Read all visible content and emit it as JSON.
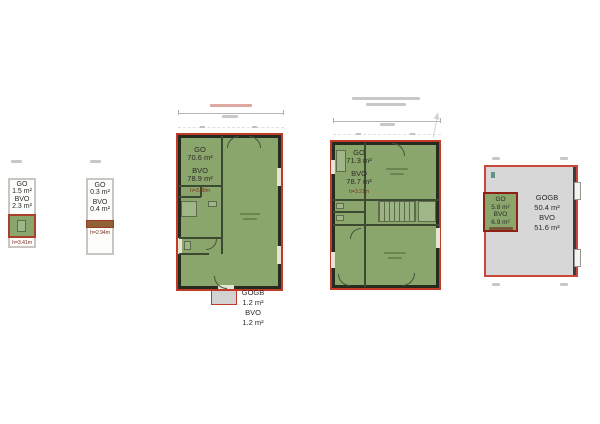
{
  "sheet": {
    "background": "#ffffff"
  },
  "colors": {
    "plan_green": "#8aa66c",
    "plan_gray": "#d7d7d7",
    "outline_red": "#c23b27",
    "inner_box_red": "#8e2114",
    "wall_dark": "#262b1f",
    "brown_bar": "#8f6134",
    "height_note_text": "#7d3222"
  },
  "plans": {
    "left_small": {
      "go_label": "GO",
      "go_value": "1.5 m²",
      "bvo_label": "BVO",
      "bvo_value": "2.3 m²",
      "height_note": "h=3.41m"
    },
    "mid_small": {
      "go_label": "GO",
      "go_value": "0.3 m²",
      "bvo_label": "BVO",
      "bvo_value": "0.4 m²",
      "height_note": "h=2.94m"
    },
    "main_floor": {
      "go_label": "GO",
      "go_value": "70.6 m²",
      "bvo_label": "BVO",
      "bvo_value": "78.9 m²",
      "height_note": "h=3.08m",
      "annex": {
        "gogb_label": "GOGB",
        "gogb_value": "1.2 m²",
        "bvo_label": "BVO",
        "bvo_value": "1.2 m²"
      }
    },
    "upper_floor": {
      "go_label": "GO",
      "go_value": "71.3 m²",
      "bvo_label": "BVO",
      "bvo_value": "78.7 m²",
      "height_note": "h=3.21m"
    },
    "roof": {
      "gogb_label": "GOGB",
      "gogb_value": "50.4 m²",
      "bvo_label": "BVO",
      "bvo_value": "51.6 m²",
      "inner": {
        "go_label": "GO",
        "go_value": "5.8 m²",
        "bvo_label": "BVO",
        "bvo_value": "6.9 m²"
      }
    }
  }
}
